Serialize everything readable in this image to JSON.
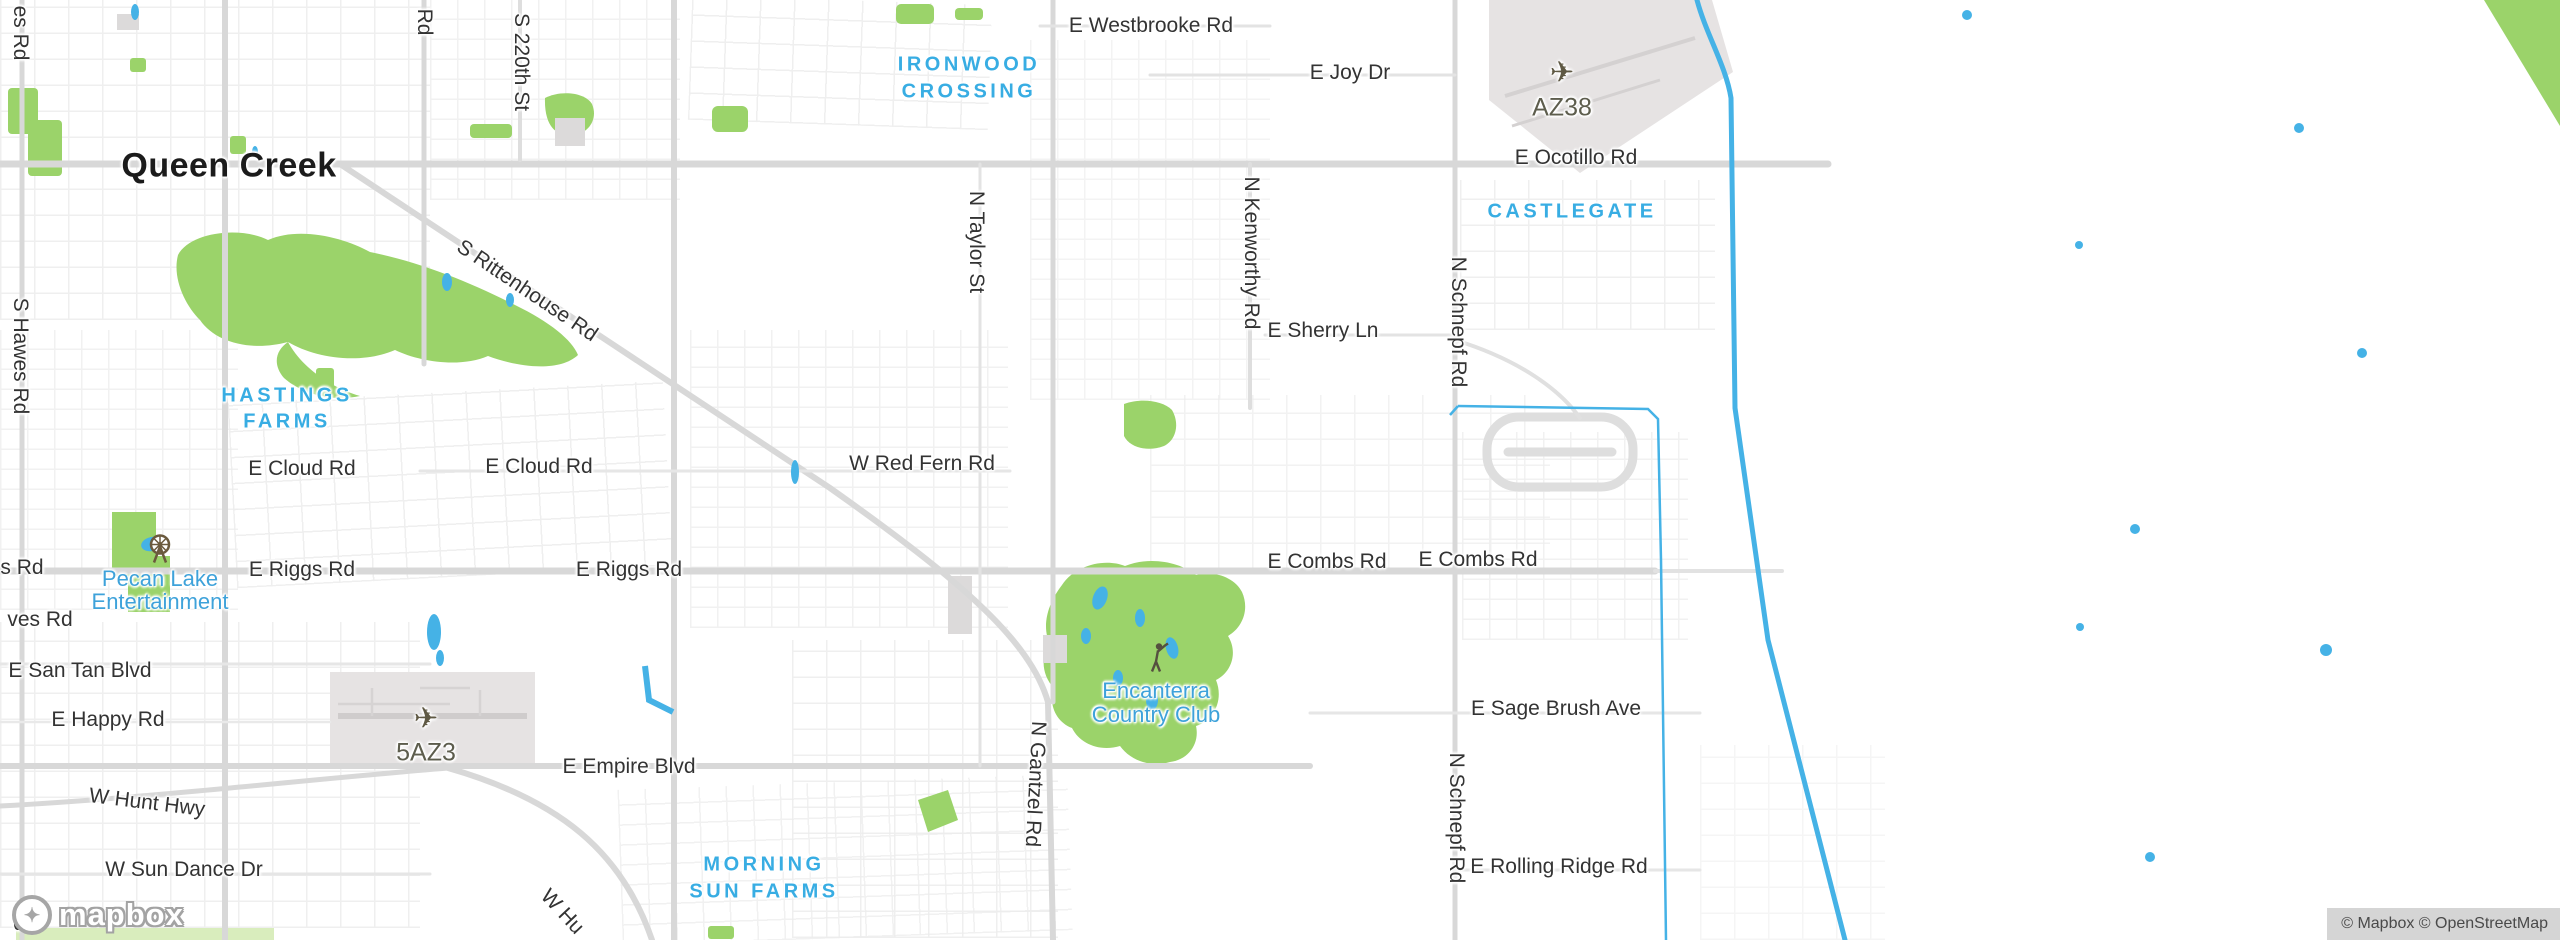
{
  "city": {
    "label": "Queen Creek"
  },
  "neighborhoods": {
    "ironwood": {
      "line1": "IRONWOOD",
      "line2": "CROSSING"
    },
    "castlegate": {
      "label": "CASTLEGATE"
    },
    "hastings": {
      "line1": "HASTINGS",
      "line2": "FARMS"
    },
    "morning_sun": {
      "line1": "MORNING",
      "line2": "SUN FARMS"
    }
  },
  "pois": {
    "pecan_lake": {
      "line1": "Pecan Lake",
      "line2": "Entertainment",
      "icon": "ferris-wheel"
    },
    "encanterra": {
      "line1": "Encanterra",
      "line2": "Country Club",
      "icon": "golfer"
    }
  },
  "airports": {
    "az38": {
      "code": "AZ38",
      "icon": "airplane"
    },
    "az3_5": {
      "code": "5AZ3",
      "icon": "airplane"
    }
  },
  "roads": {
    "westbrooke": "E Westbrooke Rd",
    "joy": "E Joy Dr",
    "ocotillo": "E Ocotillo Rd",
    "sherry": "E Sherry Ln",
    "cloud_w": "E Cloud Rd",
    "cloud_e": "E Cloud Rd",
    "red_fern": "W Red Fern Rd",
    "riggs_w": "E Riggs Rd",
    "riggs_e": "E Riggs Rd",
    "combs_w": "E Combs Rd",
    "combs_e": "E Combs Rd",
    "san_tan": "E San Tan Blvd",
    "happy": "E Happy Rd",
    "empire": "E Empire Blvd",
    "hunt": "W Hunt Hwy",
    "hunt_cut": "W Hu",
    "sun_dance": "W Sun Dance Dr",
    "sage_brush": "E Sage Brush Ave",
    "rolling_ridge": "E Rolling Ridge Rd",
    "hawes": "S Hawes Rd",
    "hawes_top_cut": "es Rd",
    "hawes_bottom_cut": "S",
    "riggs_left_cut": "s Rd",
    "hawes_left_cut": "ves Rd",
    "rd_cut": "Rd",
    "st_220th": "S 220th St",
    "taylor": "N Taylor St",
    "kenworthy": "N Kenworthy Rd",
    "schnepf_n": "N Schnepf Rd",
    "schnepf_s": "N Schnepf Rd",
    "gantzel": "N Gantzel Rd",
    "rittenhouse": "S Rittenhouse Rd"
  },
  "branding": {
    "logo_text": "mapbox",
    "attribution": "© Mapbox © OpenStreetMap"
  },
  "colors": {
    "park_green": "#9bd36a",
    "pale_green": "#d9edbd",
    "water_blue": "#45b2e6",
    "poi_blue": "#3ea2da",
    "neighborhood_blue": "#38ade3",
    "major_road": "#d8d8d8",
    "road_label": "#333333",
    "airport_fill": "#e6e3e3",
    "airport_label": "#5d5d4d"
  }
}
